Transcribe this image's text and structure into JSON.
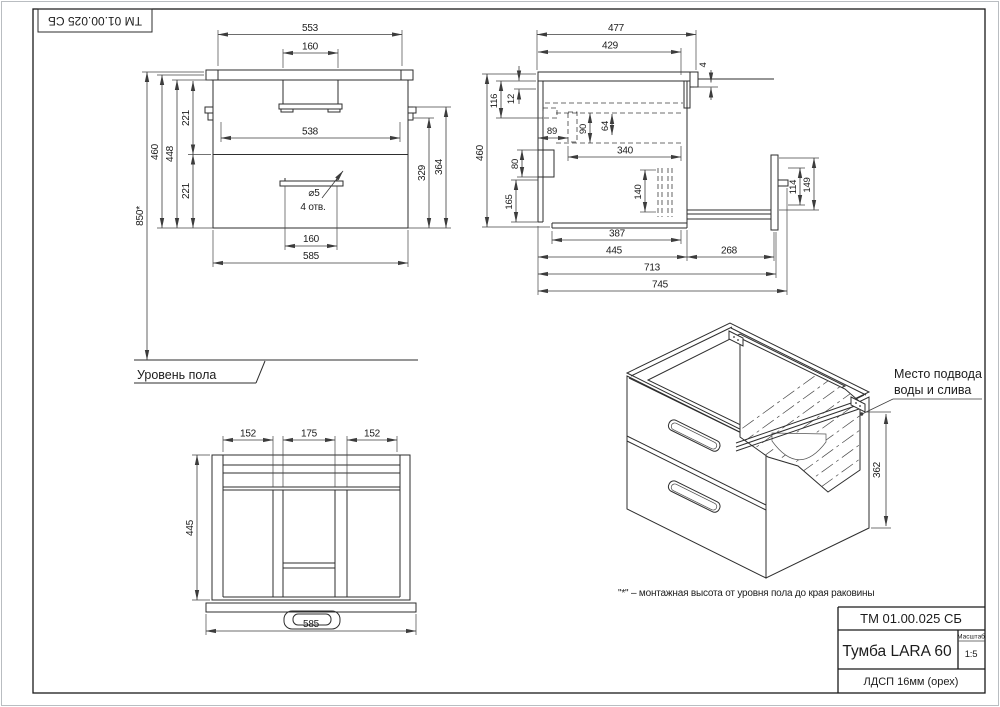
{
  "colors": {
    "line": "#2e2e2e",
    "background": "#ffffff"
  },
  "stamp": {
    "top_left": "ТМ 01.00.025 СБ"
  },
  "title_block": {
    "doc_number": "ТМ 01.00.025 СБ",
    "product_title": "Тумба LARA 60",
    "scale_label": "Масштаб",
    "scale_value": "1:5",
    "material": "ЛДСП 16мм (орех)"
  },
  "notes": {
    "floor_level": "Уровень пола",
    "mounting_note": "\"*\" – монтажная высота от уровня пола до края раковины",
    "water_note_line1": "Место подвода",
    "water_note_line2": "воды и слива"
  },
  "front_view": {
    "dim_553": "553",
    "dim_160_top": "160",
    "dim_538": "538",
    "dim_850": "850*",
    "dim_460": "460",
    "dim_448": "448",
    "dim_221_upper": "221",
    "dim_221_lower": "221",
    "dim_364": "364",
    "dim_329": "329",
    "hole_dia": "⌀5",
    "hole_count": "4 отв.",
    "dim_160_bottom": "160",
    "dim_585": "585"
  },
  "side_view": {
    "dim_477": "477",
    "dim_429": "429",
    "dim_4": "4",
    "dim_116": "116",
    "dim_12": "12",
    "dim_89": "89",
    "dim_90": "90",
    "dim_64": "64",
    "dim_340": "340",
    "dim_460": "460",
    "dim_80": "80",
    "dim_165": "165",
    "dim_140": "140",
    "dim_114": "114",
    "dim_149": "149",
    "dim_387": "387",
    "dim_445": "445",
    "dim_268": "268",
    "dim_713": "713",
    "dim_745": "745"
  },
  "plan_view": {
    "dim_152_left": "152",
    "dim_175": "175",
    "dim_152_right": "152",
    "dim_445": "445",
    "dim_585": "585"
  },
  "iso_view": {
    "dim_362": "362"
  }
}
